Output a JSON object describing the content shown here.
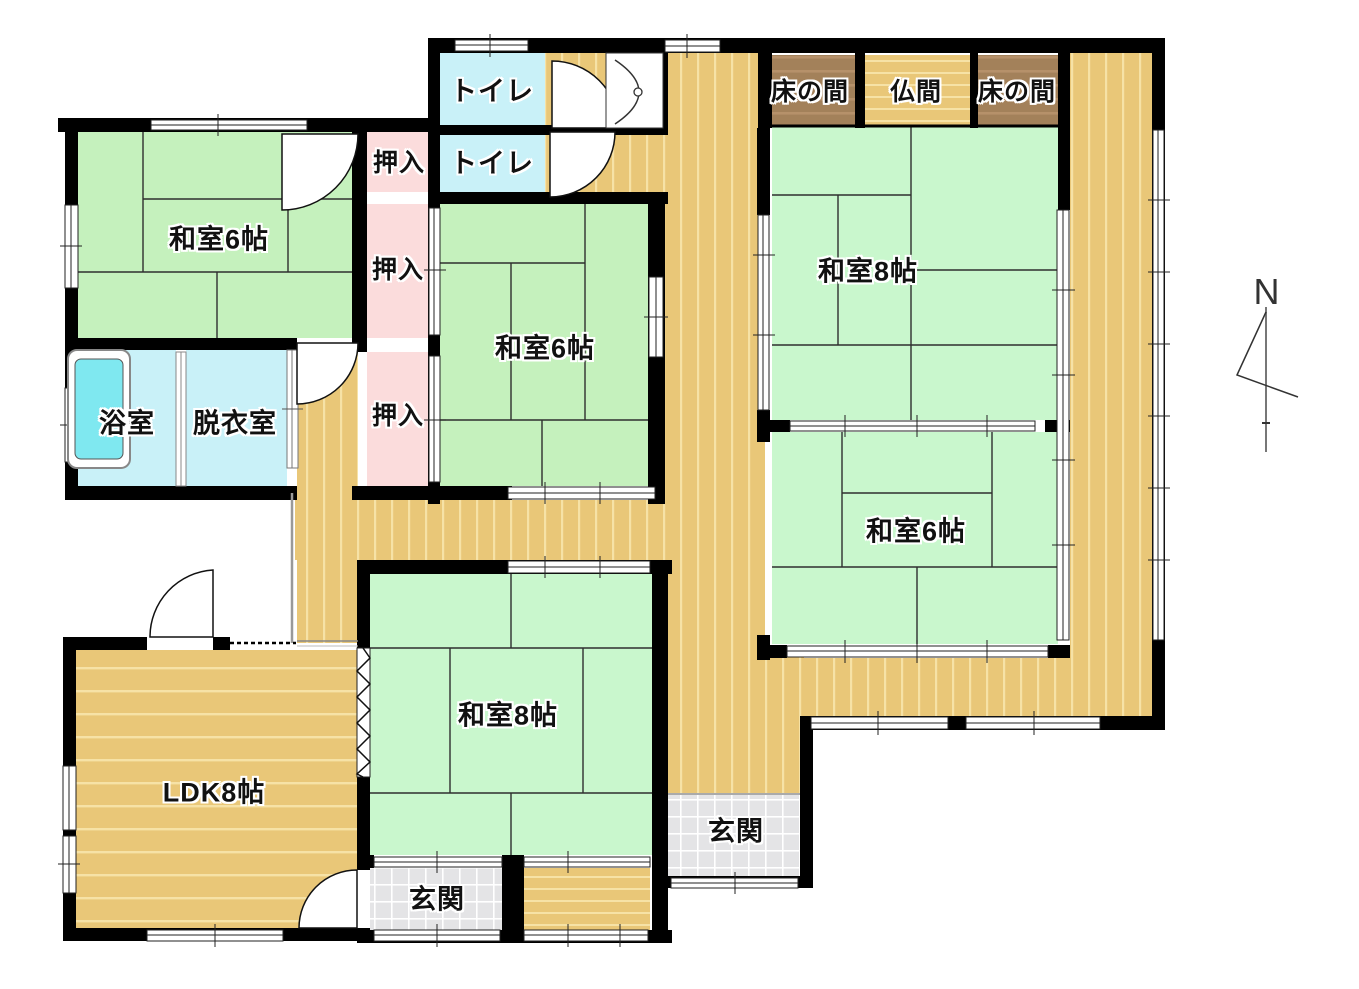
{
  "title": "間取り図 (floor plan)",
  "palette": {
    "wall": "#000000",
    "tatami": "#c5f1bd",
    "tatami_mint": "#c9f7cd",
    "wood": "#e9c778",
    "wood_stripe": "#f6e2a6",
    "pink": "#fbdcdc",
    "cyan": "#c9f1f8",
    "tub": "#7fe8f0",
    "tokonoma": "#a3815a",
    "tokonoma_stripe": "#b6916a",
    "genkan": "#e4e4e6",
    "genkan_line": "#ffffff",
    "matline": "#2f2f2f"
  },
  "labels": {
    "toilet_upper": "トイレ",
    "toilet_lower": "トイレ",
    "closet_top": "押入",
    "closet_mid": "押入",
    "closet_low": "押入",
    "washitsu6_nw": "和室6帖",
    "washitsu6_center": "和室6帖",
    "washitsu6_east": "和室6帖",
    "washitsu8_ne": "和室8帖",
    "washitsu8_south": "和室8帖",
    "tokonoma_left": "床の間",
    "butsuma": "仏間",
    "tokonoma_right": "床の間",
    "bath": "浴室",
    "dressing": "脱衣室",
    "ldk": "LDK8帖",
    "genkan_east": "玄関",
    "genkan_south": "玄関",
    "compass_north": "N"
  }
}
